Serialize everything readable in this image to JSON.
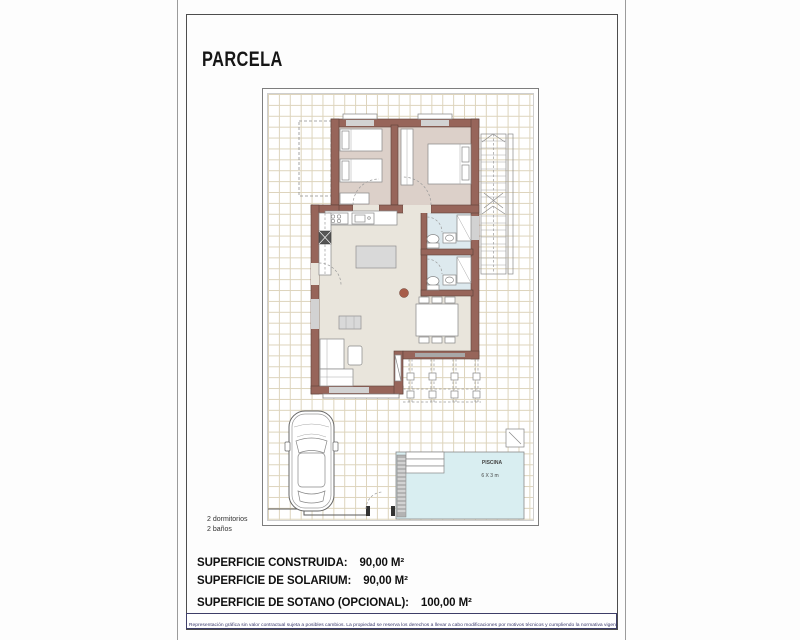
{
  "page": {
    "title": "PARCELA",
    "notes": [
      "2 dormitorios",
      "2 baños"
    ],
    "surfaces": [
      {
        "label": "SUPERFICIE CONSTRUIDA:",
        "value": "90,00 M²"
      },
      {
        "label": "SUPERFICIE DE SOLARIUM:",
        "value": "90,00 M²"
      },
      {
        "label": "SUPERFICIE DE SOTANO (OPCIONAL):",
        "value": "100,00 M²"
      }
    ],
    "disclaimer": "Representación gráfica sin valor contractual sujeta a posibles cambios. La propiedad se reserva los derechos a llevar a cabo modificaciones por motivos técnicos y cumpliendo la normativa vigente."
  },
  "plan": {
    "pool": {
      "label": "PISCINA",
      "size": "6 X 3 m"
    },
    "colors": {
      "wall": "#97655a",
      "bedroom_floor": "#dcd0c9",
      "living_floor": "#e9e5dc",
      "bath_floor": "#dde9ee",
      "pool": "#d9eef1",
      "grid": "#ddd4bc"
    }
  }
}
